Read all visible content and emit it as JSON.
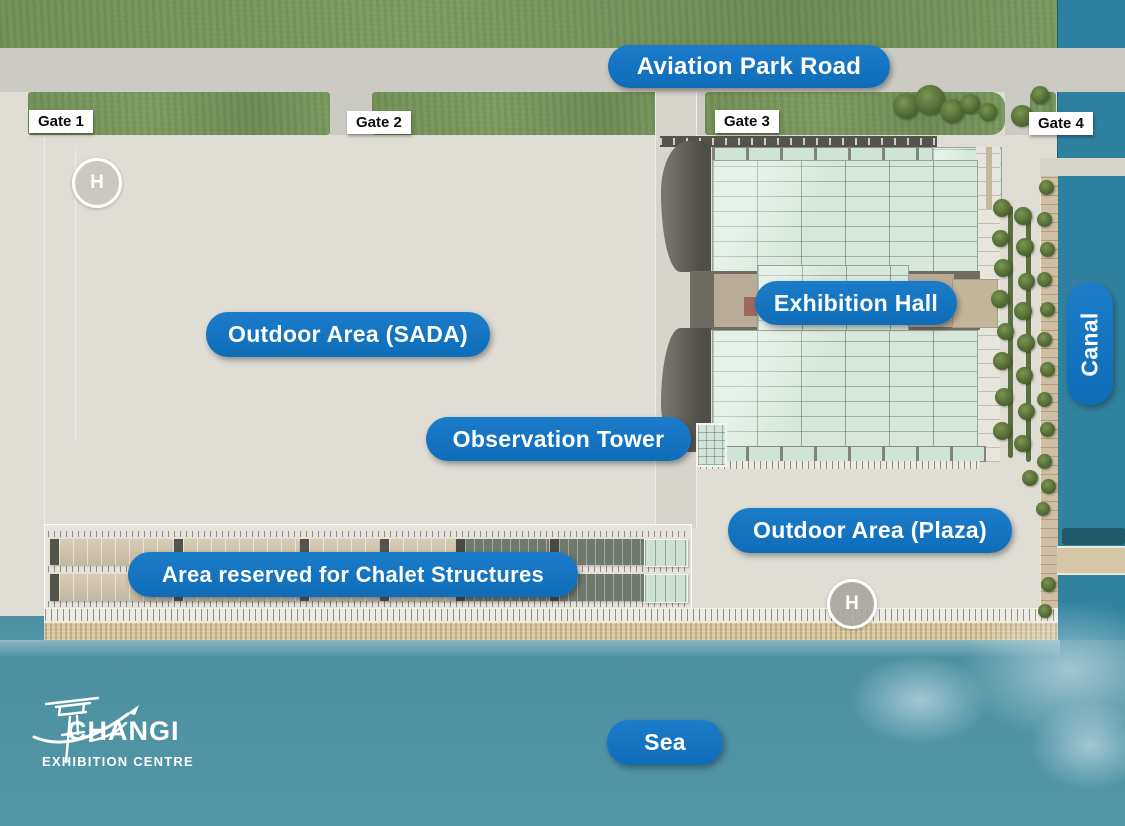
{
  "map": {
    "road": {
      "label": "Aviation Park Road"
    },
    "gates": [
      {
        "label": "Gate 1"
      },
      {
        "label": "Gate 2"
      },
      {
        "label": "Gate 3"
      },
      {
        "label": "Gate 4"
      }
    ],
    "areas": {
      "sada": "Outdoor Area (SADA)",
      "exhibition_hall": "Exhibition Hall",
      "observation_tower": "Observation Tower",
      "plaza": "Outdoor Area (Plaza)",
      "chalet": "Area reserved for Chalet Structures",
      "canal": "Canal",
      "sea": "Sea"
    },
    "helipad": {
      "letter": "H"
    },
    "logo": {
      "name": "CHANGI",
      "subtitle": "EXHIBITION CENTRE"
    },
    "colors": {
      "label_blue": "#1373c2",
      "canal_water": "#2d7f9f",
      "sea_water": "#4e93a4",
      "grass_green": "#7e9d64"
    }
  }
}
